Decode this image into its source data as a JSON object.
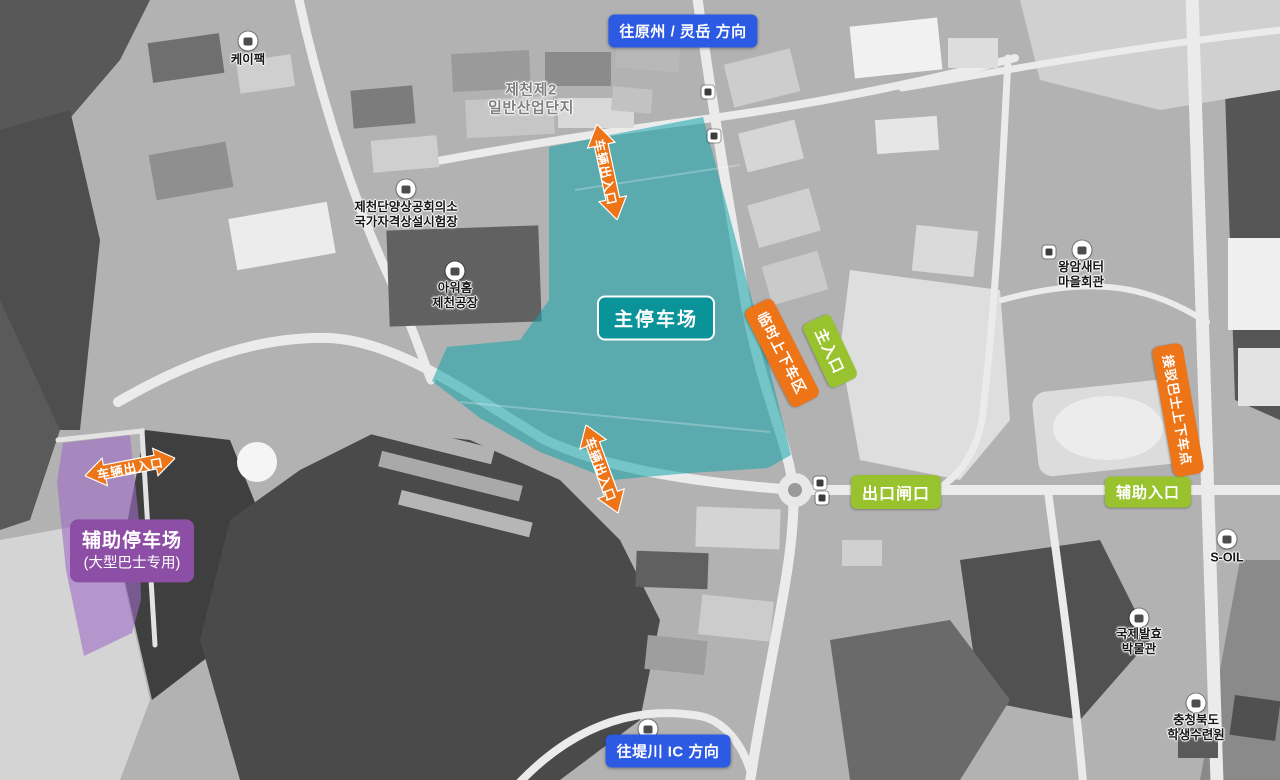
{
  "colors": {
    "blue": "#2d5ae2",
    "green": "#98c32f",
    "orange": "#ee7418",
    "teal": "#0a9398",
    "purple": "#8d4fa5",
    "tealfill": "rgba(18,164,172,0.55)",
    "purplefill": "rgba(160,108,198,0.6)"
  },
  "badges": {
    "top": "往原州 / 灵岳 方向",
    "bottom": "往堤川 IC 方向"
  },
  "parking": {
    "main": {
      "label": "主停车场"
    },
    "aux": {
      "line1": "辅助停车场",
      "line2": "(大型巴士专用)"
    }
  },
  "gates": {
    "main_entrance": "主入口",
    "exit_gate": "出口闸口",
    "aux_entrance": "辅助入口",
    "temp_dropoff": "临时上下车区",
    "shuttle_stop": "接驳巴士上下车点"
  },
  "arrows": {
    "vehicle_access": "车辆出入口"
  },
  "poi": [
    {
      "line1": "케이팩",
      "line2": ""
    },
    {
      "line1": "제천제2",
      "line2": "일반산업단지"
    },
    {
      "line1": "제천단양상공회의소",
      "line2": "국가자격상설시험장"
    },
    {
      "line1": "아워홈",
      "line2": "제천공장"
    },
    {
      "line1": "왕암새터",
      "line2": "마을회관"
    },
    {
      "line1": "S-OIL",
      "line2": ""
    },
    {
      "line1": "국제발효",
      "line2": "박물관"
    },
    {
      "line1": "충청북도",
      "line2": "학생수련원"
    }
  ]
}
